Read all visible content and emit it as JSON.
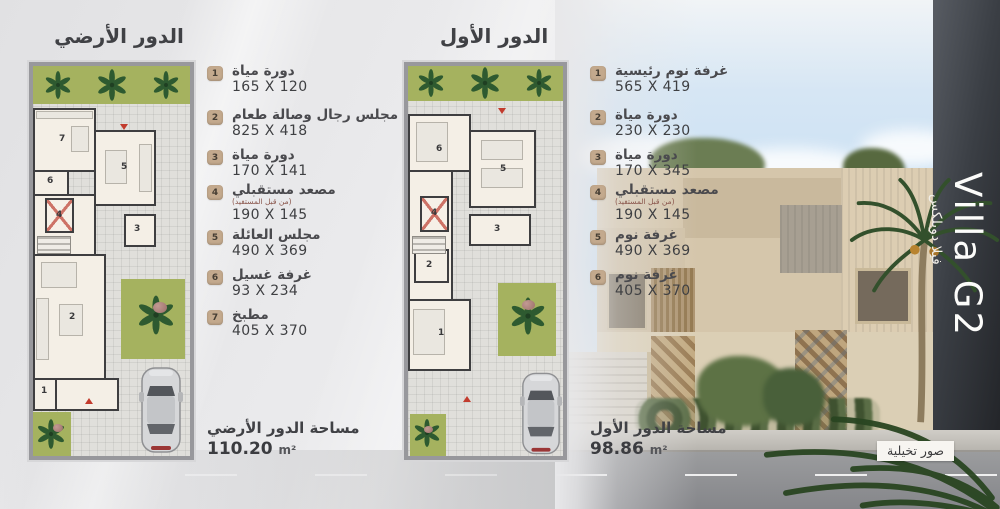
{
  "villa": {
    "name_en": "Villa G2",
    "name_ar": "فيلا دوبلكس",
    "disclaimer_badge": "صور تخيلية"
  },
  "ground_floor": {
    "title": "الدور الأرضي",
    "area_label": "مساحة الدور الأرضي",
    "area_value": "110.20",
    "area_unit": "m²",
    "legend": [
      {
        "num": "1",
        "name": "دورة مياة",
        "note": "",
        "dims": "165 X 120"
      },
      {
        "num": "2",
        "name": "مجلس رجال وصالة طعام",
        "note": "",
        "dims": "825 X 418"
      },
      {
        "num": "3",
        "name": "دورة مياة",
        "note": "",
        "dims": "170 X 141"
      },
      {
        "num": "4",
        "name": "مصعد مستقبلي",
        "note": "(من قبل المستفيد)",
        "dims": "190 X 145"
      },
      {
        "num": "5",
        "name": "مجلس العائلة",
        "note": "",
        "dims": "490 X 369"
      },
      {
        "num": "6",
        "name": "غرفة غسيل",
        "note": "",
        "dims": "93 X 234"
      },
      {
        "num": "7",
        "name": "مطبخ",
        "note": "",
        "dims": "405 X 370"
      }
    ]
  },
  "first_floor": {
    "title": "الدور الأول",
    "area_label": "مساحة الدور الأول",
    "area_value": "98.86",
    "area_unit": "m²",
    "legend": [
      {
        "num": "1",
        "name": "غرفة نوم رئيسية",
        "note": "",
        "dims": "565 X 419"
      },
      {
        "num": "2",
        "name": "دورة مياة",
        "note": "",
        "dims": "230 X 230"
      },
      {
        "num": "3",
        "name": "دورة مياة",
        "note": "",
        "dims": "170 X 345"
      },
      {
        "num": "4",
        "name": "مصعد مستقبلي",
        "note": "(من قبل المستفيد)",
        "dims": "190 X 145"
      },
      {
        "num": "5",
        "name": "غرفة نوم",
        "note": "",
        "dims": "490 X 369"
      },
      {
        "num": "6",
        "name": "غرفة نوم",
        "note": "",
        "dims": "405 X 370"
      }
    ]
  },
  "colors": {
    "legend_marker": "#c3a98d",
    "text_dark": "#404145",
    "plan_wall": "#3e3e40",
    "plan_green": "#a5b25f",
    "plan_room": "#f4efe6",
    "sky": "#c3ddf3",
    "villa_beige": "#d5c6ab",
    "dark_wall": "#34373c",
    "road": "#8d8e90",
    "entrance_arrow_red": "#c23b2d"
  }
}
